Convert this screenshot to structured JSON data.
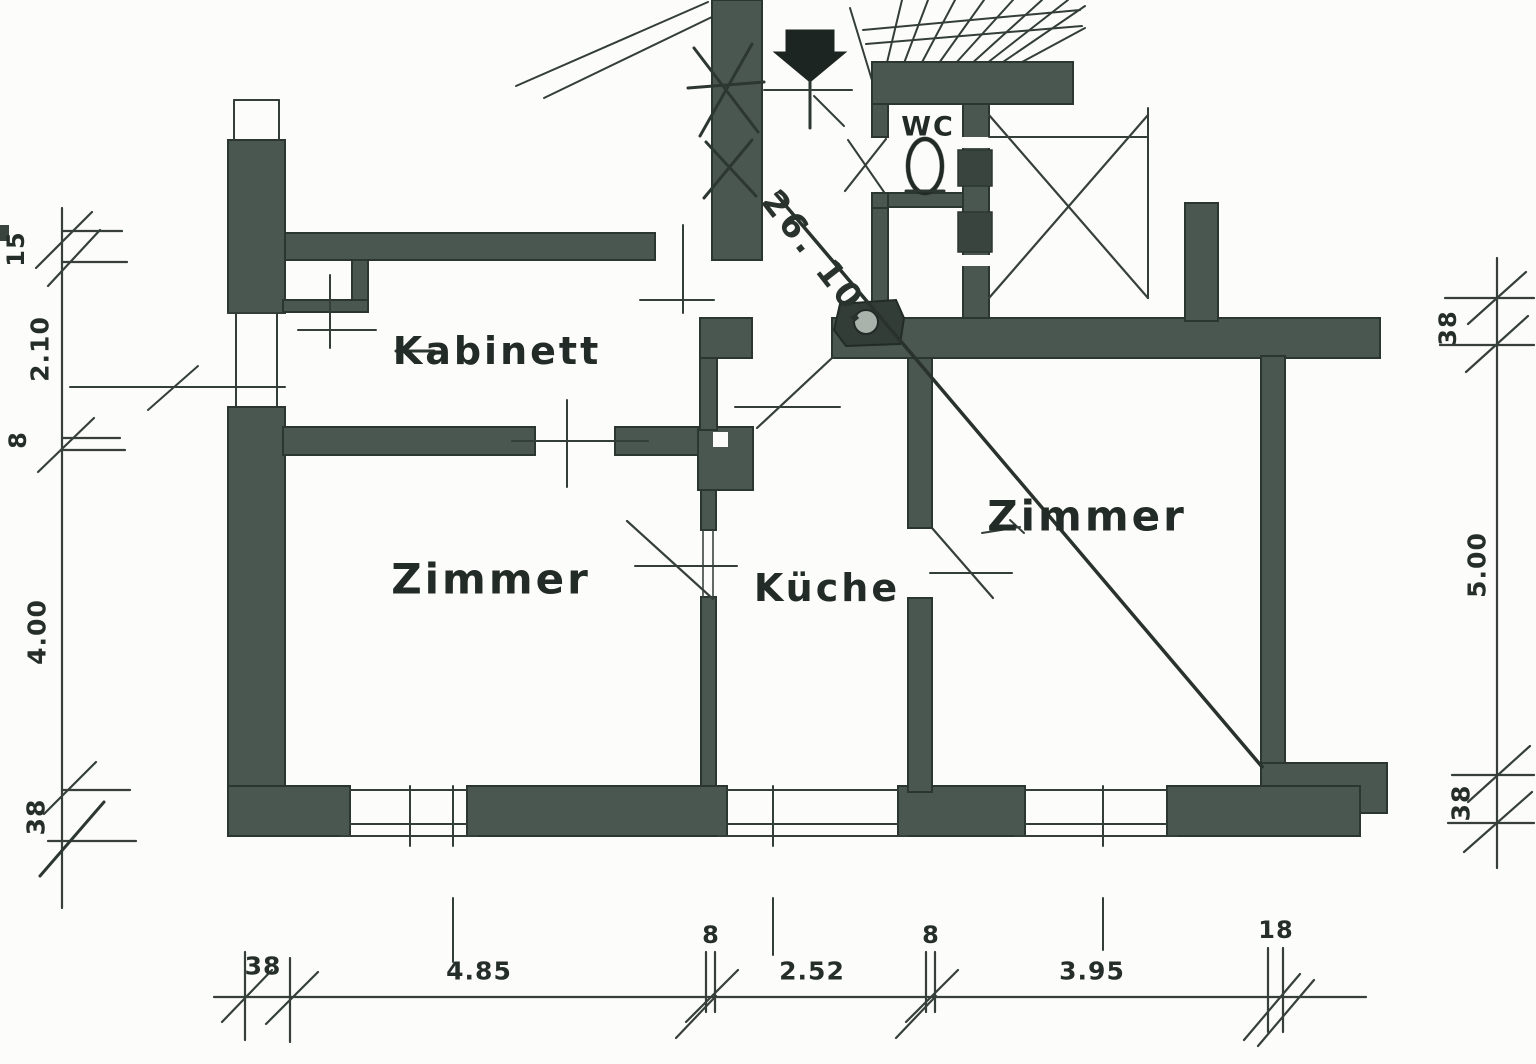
{
  "drawing": {
    "kind": "apartment floor plan (scanned hand drawing)",
    "wall_color": "#4a5750",
    "line_color": "#2e3833",
    "paper_color": "#fcfcfa"
  },
  "rooms": {
    "kabinett": "Kabinett",
    "zimmer_left": "Zimmer",
    "kueche": "Küche",
    "zimmer_right": "Zimmer",
    "wc": "WC"
  },
  "annotation": {
    "note": "26. 10."
  },
  "dimensions": {
    "left": [
      "15",
      "2.10",
      "8",
      "4.00",
      "38"
    ],
    "right": [
      "38",
      "5.00",
      "38"
    ],
    "bottom": [
      "38",
      "4.85",
      "8",
      "2.52",
      "8",
      "3.95",
      "18"
    ]
  }
}
